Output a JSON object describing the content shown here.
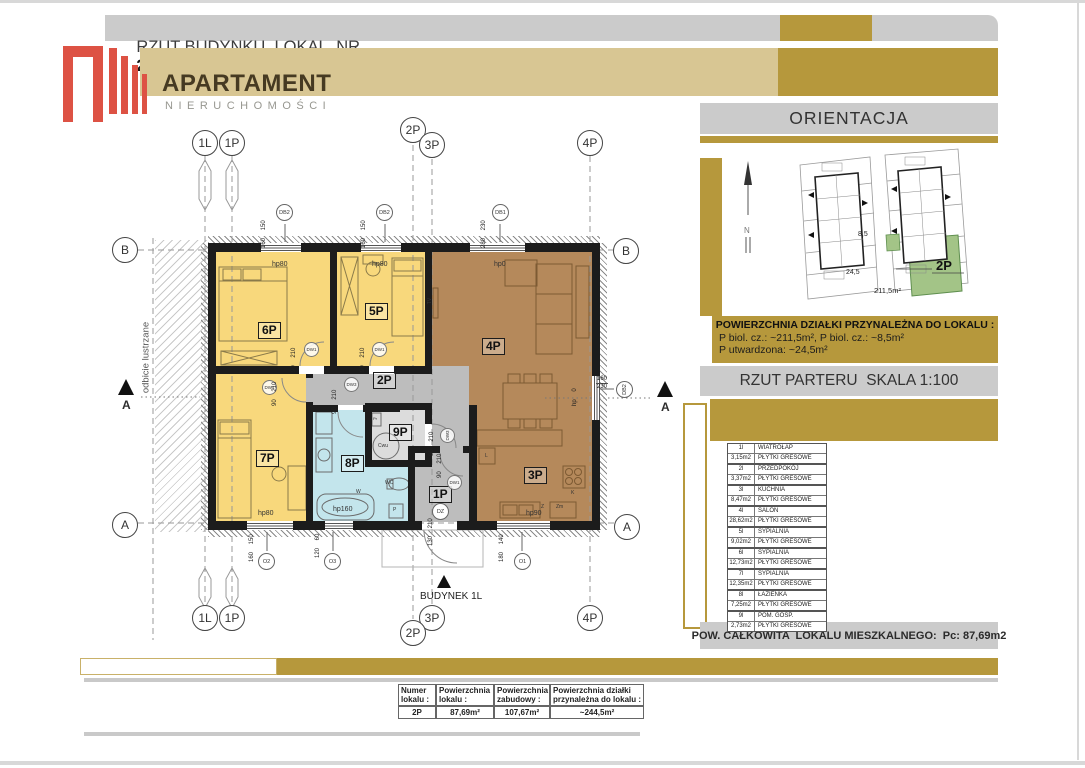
{
  "colors": {
    "gold": "#B6983C",
    "tan": "#D8C693",
    "gray_bar": "#CBCBCB",
    "room_yellow": "#F8D87C",
    "room_brown": "#B5895B",
    "room_blue": "#C3E5EC",
    "room_gray": "#BDBDBD",
    "green_plot": "#A3C487",
    "logo_red": "#DD5244"
  },
  "header": {
    "title": "RZUT BUDYNKU  LOKAL  NR",
    "unit": "2P"
  },
  "logo": {
    "name": "APARTAMENT",
    "subtitle": "NIERUCHOMOŚCI"
  },
  "orientation": {
    "title": "ORIENTACJA",
    "north": "N",
    "site": {
      "biol_small": "8,5",
      "paved": "24,5",
      "green_area": "211,5m²",
      "unit": "2P"
    },
    "plot_info": {
      "heading": "POWIERZCHNIA DZIAŁKI PRZYNALEŻNA DO LOKALU :",
      "line1": "P biol. cz.: ~211,5m², P biol. cz.: ~8,5m²",
      "line2": "P utwardzona: ~24,5m²"
    },
    "section_title": "RZUT PARTERU  SKALA 1:100",
    "legend": {
      "rows": [
        {
          "no": "1l",
          "area": "3,15m2",
          "name": "WIATROŁAP",
          "finish": "PŁYTKI GRESOWE"
        },
        {
          "no": "2l",
          "area": "3,37m2",
          "name": "PRZEDPOKÓJ",
          "finish": "PŁYTKI GRESOWE"
        },
        {
          "no": "3l",
          "area": "8,47m2",
          "name": "KUCHNIA",
          "finish": "PŁYTKI GRESOWE"
        },
        {
          "no": "4l",
          "area": "28,62m2",
          "name": "SALON",
          "finish": "PŁYTKI GRESOWE"
        },
        {
          "no": "5l",
          "area": "9,02m2",
          "name": "SYPIALNIA",
          "finish": "PŁYTKI GRESOWE"
        },
        {
          "no": "6l",
          "area": "12,73m2",
          "name": "SYPIALNIA",
          "finish": "PŁYTKI GRESOWE"
        },
        {
          "no": "7l",
          "area": "12,35m2",
          "name": "SYPIALNIA",
          "finish": "PŁYTKI GRESOWE"
        },
        {
          "no": "8l",
          "area": "7,25m2",
          "name": "ŁAZIENKA",
          "finish": "PŁYTKI GRESOWE"
        },
        {
          "no": "9l",
          "area": "2,73m2",
          "name": "POM. GOSP.",
          "finish": "PŁYTKI GRESOWE"
        }
      ]
    },
    "total": "POW. CAŁKOWITA  LOKALU MIESZKALNEGO:  Pc: 87,69m2"
  },
  "summary": {
    "headers": [
      "Numer lokalu :",
      "Powierzchnia lokalu :",
      "Powierzchnia zabudowy :",
      "Powierzchnia działki przynależna do lokalu :"
    ],
    "values": [
      "2P",
      "87,69m²",
      "107,67m²",
      "~244,5m²"
    ]
  },
  "plan": {
    "building": "BUDYNEK 1L",
    "mirror": "odbicie lustrzane",
    "grid": {
      "l1": "1L",
      "p1": "1P",
      "p2": "2P",
      "p3": "3P",
      "p4": "4P",
      "a": "A",
      "b": "B"
    },
    "rooms": {
      "r1": "1P",
      "r2": "2P",
      "r3": "3P",
      "r4": "4P",
      "r5": "5P",
      "r6": "6P",
      "r7": "7P",
      "r8": "8P",
      "r9": "9P"
    },
    "openings": {
      "db1": "DB1",
      "db2": "DB2",
      "o1": "O1",
      "o2": "O2",
      "o3": "O3",
      "dz": "DZ",
      "dw1": "DW1",
      "dw3": "DW3"
    },
    "dims": {
      "db2": "160 150",
      "db1": "280 230",
      "o2": "160 150",
      "o3": "120 60",
      "o1": "180 140",
      "door": "90 210",
      "entry": "130 210",
      "side_w": "160",
      "side_h": "230"
    },
    "hp": {
      "h80": "hp80",
      "h0": "hp0",
      "h160": "hp160",
      "h90": "hp90",
      "h0side": "hp 0"
    },
    "fixtures": {
      "tv": "TV",
      "wc": "WC",
      "w": "W",
      "p": "P",
      "cwu": "Cwu",
      "pr": "Pr",
      "l": "L",
      "k": "K",
      "z": "Z",
      "zm": "Zm"
    }
  }
}
